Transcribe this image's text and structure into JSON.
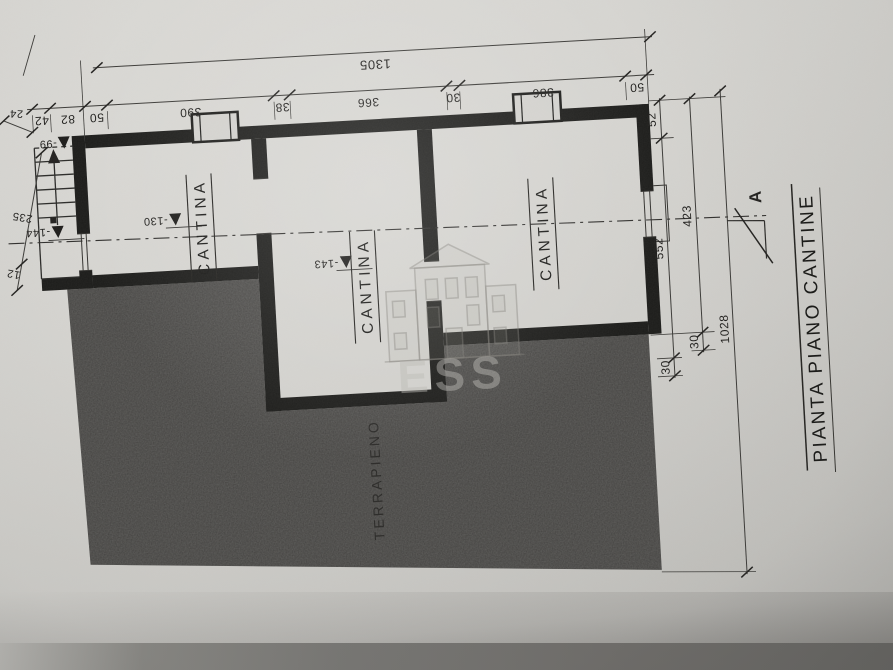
{
  "drawing": {
    "title": "PIANTA PIANO CANTINE",
    "section_letter": "A",
    "terrain_label": "TERRAPIENO",
    "watermark_text": "ESS"
  },
  "rooms": [
    {
      "label": "CANTINA",
      "level": "-130"
    },
    {
      "label": "CANTINA",
      "level": "-143"
    },
    {
      "label": "CANTINA"
    }
  ],
  "stair_levels": {
    "top": "-99",
    "bottom": "-144"
  },
  "dimensions": {
    "top_total": "1305",
    "top_chain": [
      "42",
      "82",
      "50",
      "390",
      "38",
      "366",
      "30",
      "386",
      "50"
    ],
    "left_offset": "24",
    "left_chain": [
      "235",
      "12"
    ],
    "right_inner": [
      "52",
      "552",
      "30"
    ],
    "right_middle": [
      "423",
      "30"
    ],
    "right_total": "1028"
  },
  "colors": {
    "ink": "#1c1c1c",
    "paper": "#d3d2ce",
    "terrain_fill": "#3f3e3c"
  }
}
